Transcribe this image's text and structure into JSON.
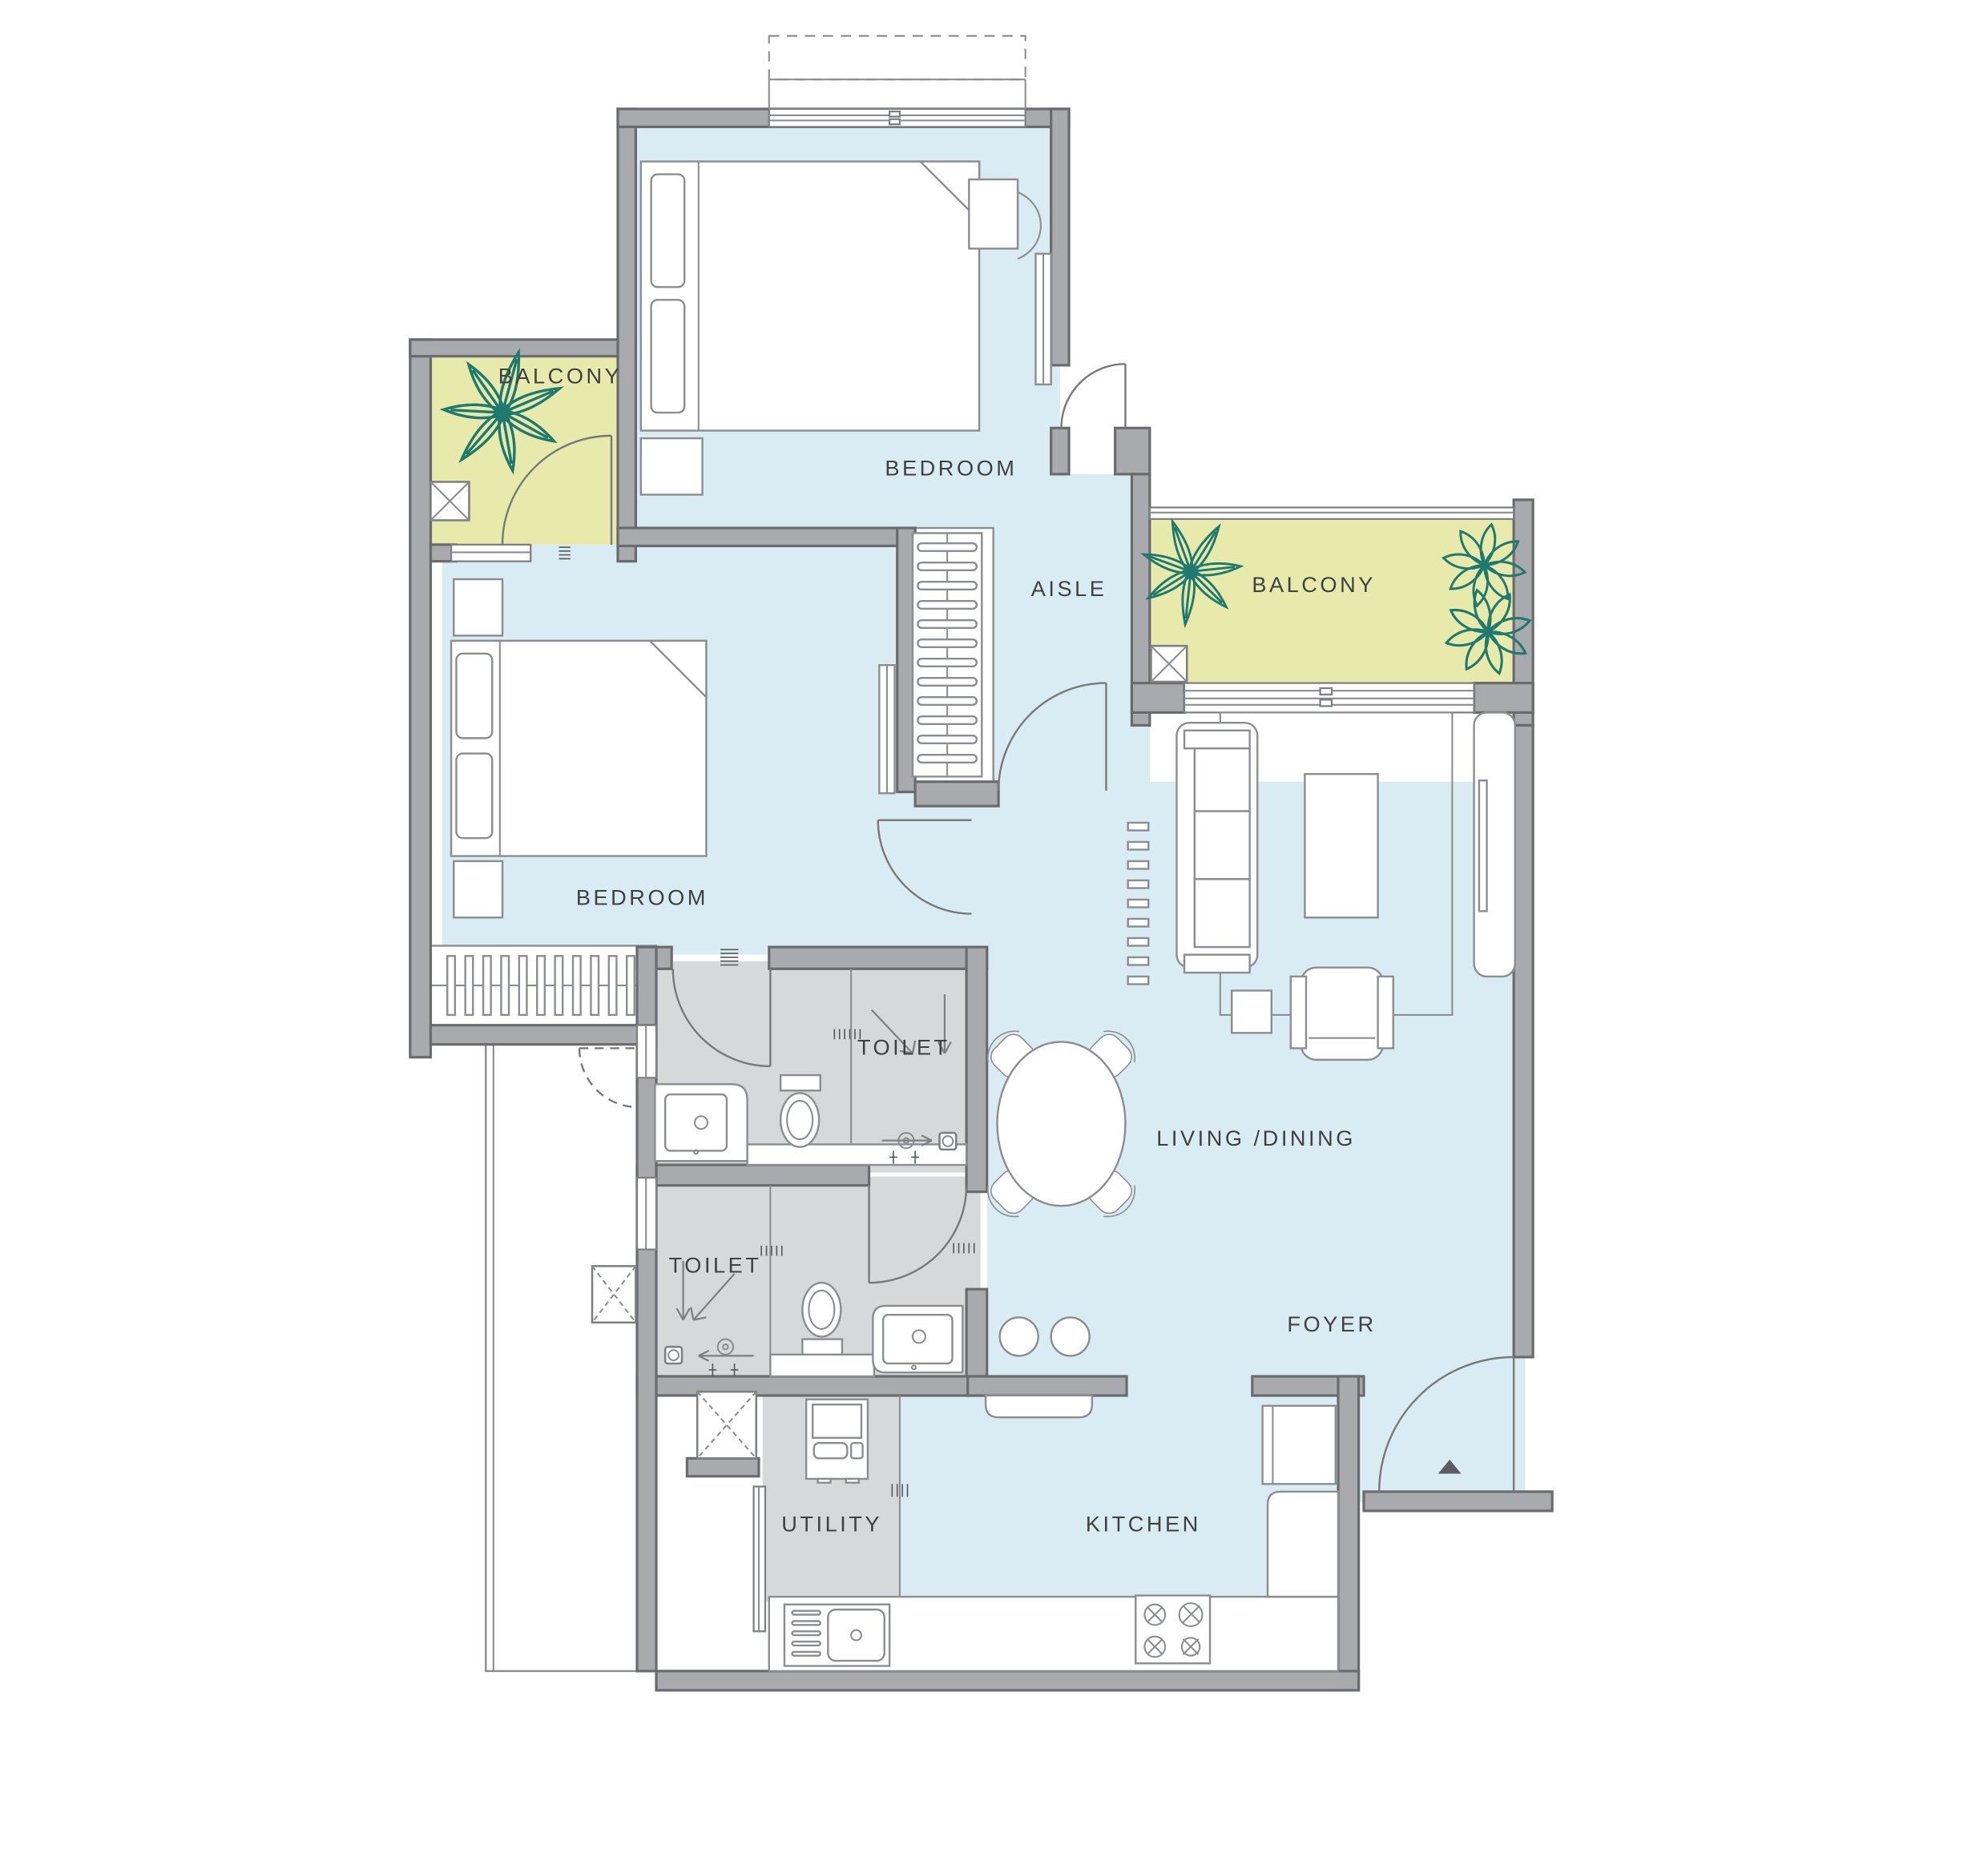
{
  "colors": {
    "wall": "#a8aaad",
    "wall_edge": "#696b6e",
    "floor": "#daecf3",
    "balcony": "#e7eaab",
    "wet_area": "#d7d8da",
    "furniture_line": "#8b8d90",
    "plant": "#20796f",
    "label_text": "#3f4042",
    "entry_marker": "#5a5c5e"
  },
  "rooms": {
    "balcony_left": {
      "label": "BALCONY"
    },
    "bedroom_top": {
      "label": "BEDROOM"
    },
    "aisle": {
      "label": "AISLE"
    },
    "balcony_right": {
      "label": "BALCONY"
    },
    "bedroom_left": {
      "label": "BEDROOM"
    },
    "toilet_upper": {
      "label": "TOILET"
    },
    "toilet_lower": {
      "label": "TOILET"
    },
    "living_dining": {
      "label": "LIVING /DINING"
    },
    "foyer": {
      "label": "FOYER"
    },
    "utility": {
      "label": "UTILITY"
    },
    "kitchen": {
      "label": "KITCHEN"
    }
  }
}
